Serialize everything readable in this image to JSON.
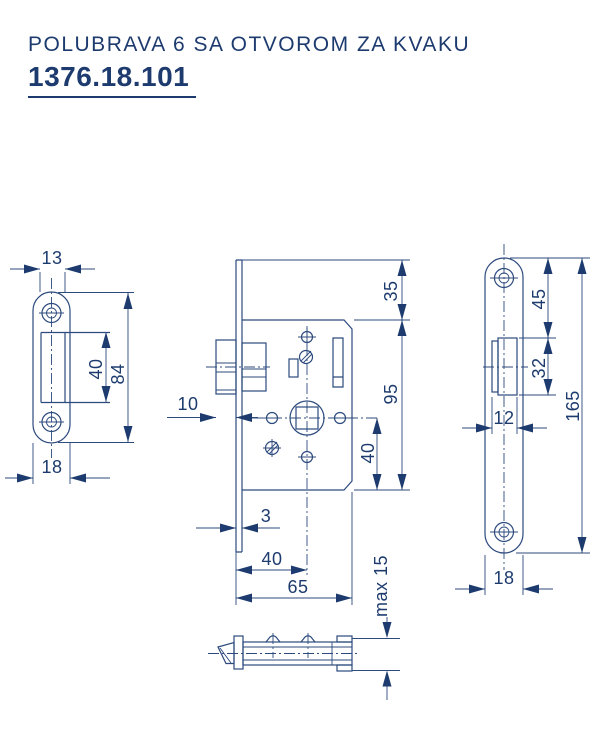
{
  "header": {
    "title": "POLUBRAVA 6 SA OTVOROM ZA KVAKU",
    "code": "1376.18.101"
  },
  "colors": {
    "accent": "#1d3b6e",
    "line": "#2c4a7d",
    "background": "#ffffff"
  },
  "drawing": {
    "views": [
      {
        "name": "strike-plate-front"
      },
      {
        "name": "lock-body-side"
      },
      {
        "name": "lock-body-plan"
      },
      {
        "name": "faceplate-front"
      }
    ]
  },
  "dims": {
    "strike": {
      "inner_width": "13",
      "slot_height": "40",
      "height": "84",
      "width": "18"
    },
    "body": {
      "top_offset": "35",
      "height": "95",
      "below_axis": "40",
      "latch_protrusion": "10",
      "plate_thickness": "3",
      "backset": "40",
      "depth": "65",
      "case_thickness": "max 15"
    },
    "faceplate": {
      "hole_top": "45",
      "hole_height": "32",
      "length": "165",
      "hole_width": "12",
      "width": "18"
    }
  }
}
